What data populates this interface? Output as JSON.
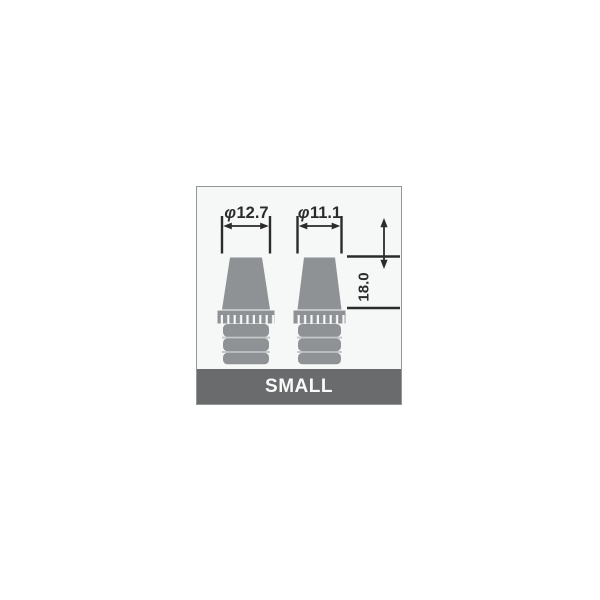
{
  "card": {
    "size_label": "SMALL",
    "colors": {
      "banner": "#696b6d",
      "banner_text": "#fafafa",
      "card_background": "#f6f7f7",
      "card_border": "#919897",
      "plug_gray": "#8f9295",
      "rib_separator": "#c6c9ca",
      "dimension_ink": "#2b2b2b"
    }
  },
  "diagram": {
    "dimensions": {
      "left_diameter": {
        "symbol": "φ",
        "value": "12.7"
      },
      "right_diameter": {
        "symbol": "φ",
        "value": "11.1"
      },
      "height": {
        "value": "18.0"
      }
    }
  }
}
